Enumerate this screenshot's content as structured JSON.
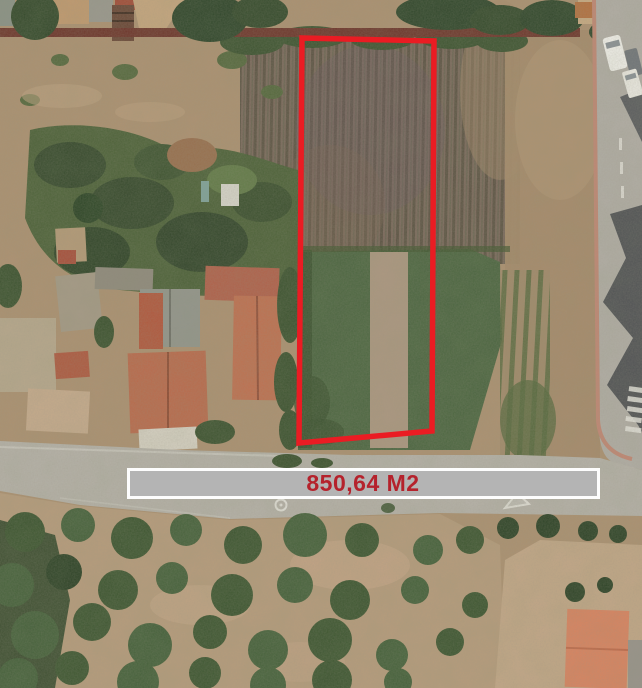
{
  "annotation": {
    "area_label": "850,64 M2",
    "outline_color": "#ea1c23",
    "banner_background": "#b4b4b4",
    "banner_border": "#fdfdfd",
    "label_color": "#b5222c"
  },
  "scene": {
    "description": "aerial satellite photograph of a rural land parcel outlined in red, surrounded by crop fields, farmhouses with terracotta roofs, a road with parked cars on the right, and an orchard of trees below",
    "palette": {
      "dirt": "#ad9171",
      "dirt_light": "#c3a787",
      "scrub_green": "#4c6138",
      "tree_dark": "#32482a",
      "crop_field_base": "#79675a",
      "crop_row": "#5d5344",
      "green_field": "#4b6540",
      "green_field_strip": "#b49b85",
      "road": "#b2aea6",
      "road_shadow": "#45484c",
      "curb_pink": "#c28774",
      "boundary_wall": "#6e352b",
      "roof_terracotta": "#bb6a4c",
      "roof_orange": "#db8360",
      "roof_gray": "#93958c",
      "vehicle_white": "#f3f2ed",
      "road_marking_white": "#e8e6df"
    }
  }
}
